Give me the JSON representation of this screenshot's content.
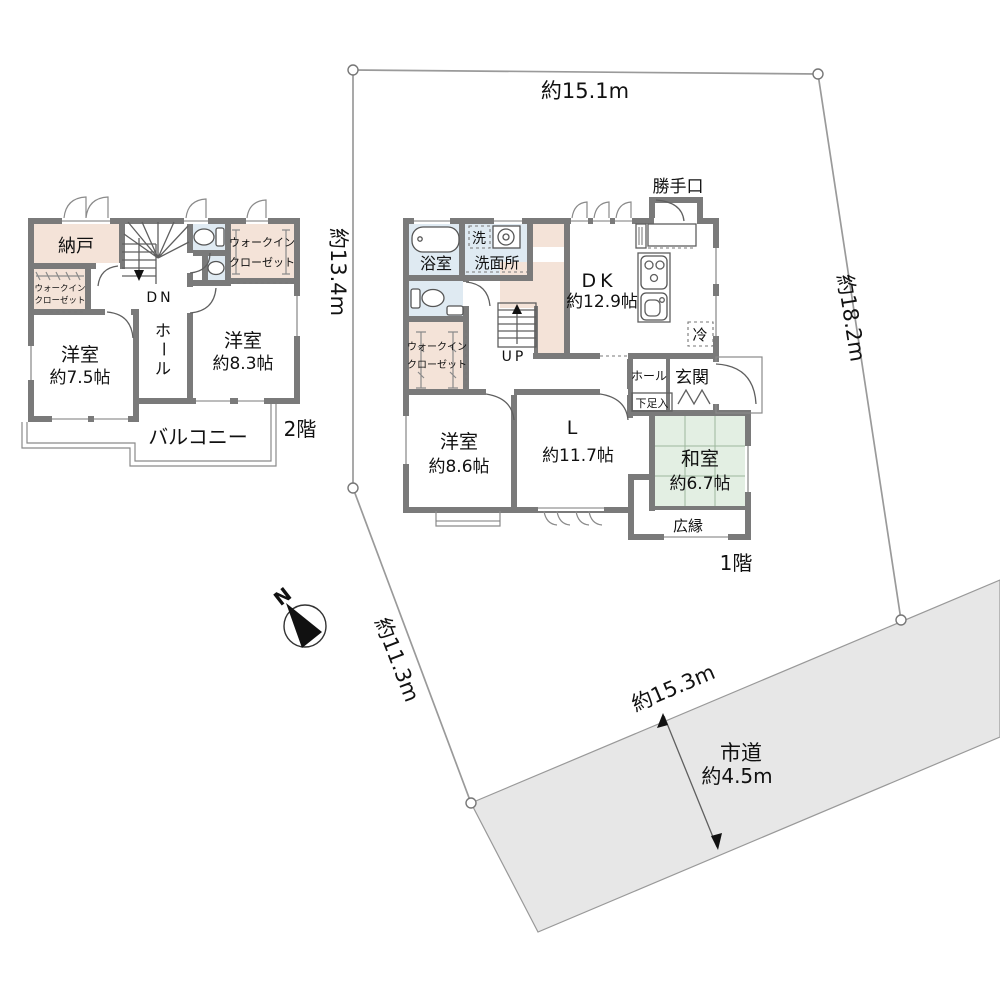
{
  "site": {
    "dim_top": "約15.1m",
    "dim_right": "約18.2m",
    "dim_left": "約13.4m",
    "dim_diag": "約11.3m",
    "road_dim": "約15.3m",
    "road_name": "市道",
    "road_width": "約4.5m",
    "north": "N"
  },
  "floor2": {
    "title": "2階",
    "storage": "納戸",
    "wic_line1": "ウォークイン",
    "wic_line2": "クローゼット",
    "room1_name": "洋室",
    "room1_size": "約7.5帖",
    "hall_chars": [
      "ホ",
      "ー",
      "ル"
    ],
    "room2_name": "洋室",
    "room2_size": "約8.3帖",
    "balcony": "バルコニー",
    "stairs_down": "DN"
  },
  "floor1": {
    "title": "1階",
    "bath": "浴室",
    "laundry": "洗",
    "washroom": "洗面所",
    "wic_line1": "ウォークイン",
    "wic_line2": "クローゼット",
    "stairs_up": "UP",
    "dk_name": "DK",
    "dk_size": "約12.9帖",
    "fridge": "冷",
    "back_door": "勝手口",
    "hall": "ホール",
    "entrance": "玄関",
    "shoe_box": "下足入",
    "room1_name": "洋室",
    "room1_size": "約8.6帖",
    "living_name": "L",
    "living_size": "約11.7帖",
    "japanese_name": "和室",
    "japanese_size": "約6.7帖",
    "veranda": "広縁"
  },
  "colors": {
    "wall": "#7a7a7a",
    "water": "#dfeaf2",
    "closet": "#f4e3d8",
    "tatami": "#e3efe3",
    "road": "#e7e7e7",
    "white": "#ffffff"
  }
}
